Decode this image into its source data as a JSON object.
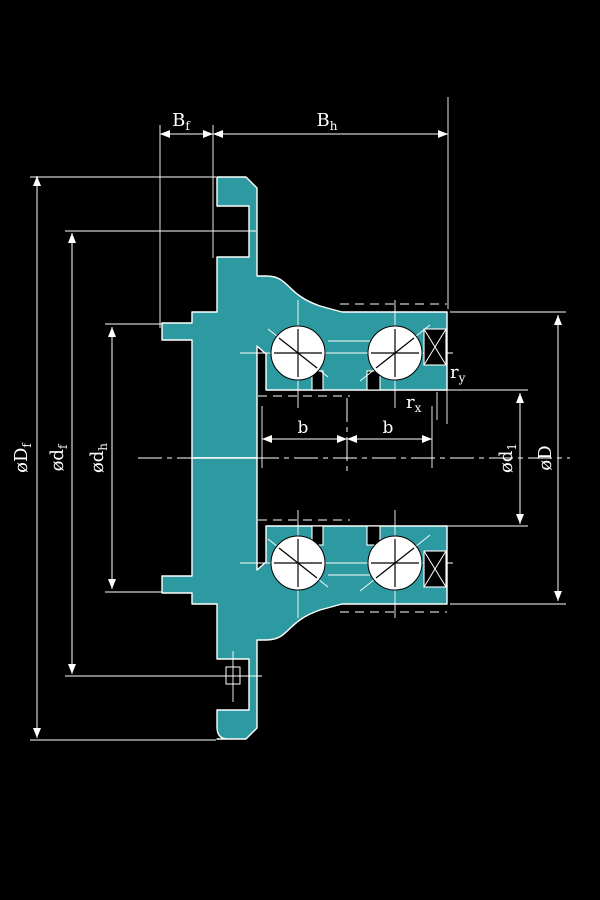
{
  "colors": {
    "background": "#000000",
    "line": "#ffffff",
    "section_fill": "#2D9AA1"
  },
  "dimensions": {
    "top": [
      {
        "main": "B",
        "sub": "f"
      },
      {
        "main": "B",
        "sub": "h"
      }
    ],
    "left": [
      {
        "main": "øD",
        "sub": "f"
      },
      {
        "main": "ød",
        "sub": "f"
      },
      {
        "main": "ød",
        "sub": "h"
      }
    ],
    "right": [
      {
        "main": "ød",
        "sub": "1"
      },
      {
        "main": "øD",
        "sub": ""
      }
    ],
    "row_spacing": [
      {
        "main": "b",
        "sub": ""
      },
      {
        "main": "b",
        "sub": ""
      }
    ],
    "radii": [
      {
        "main": "r",
        "sub": "y"
      },
      {
        "main": "r",
        "sub": "x"
      }
    ]
  }
}
